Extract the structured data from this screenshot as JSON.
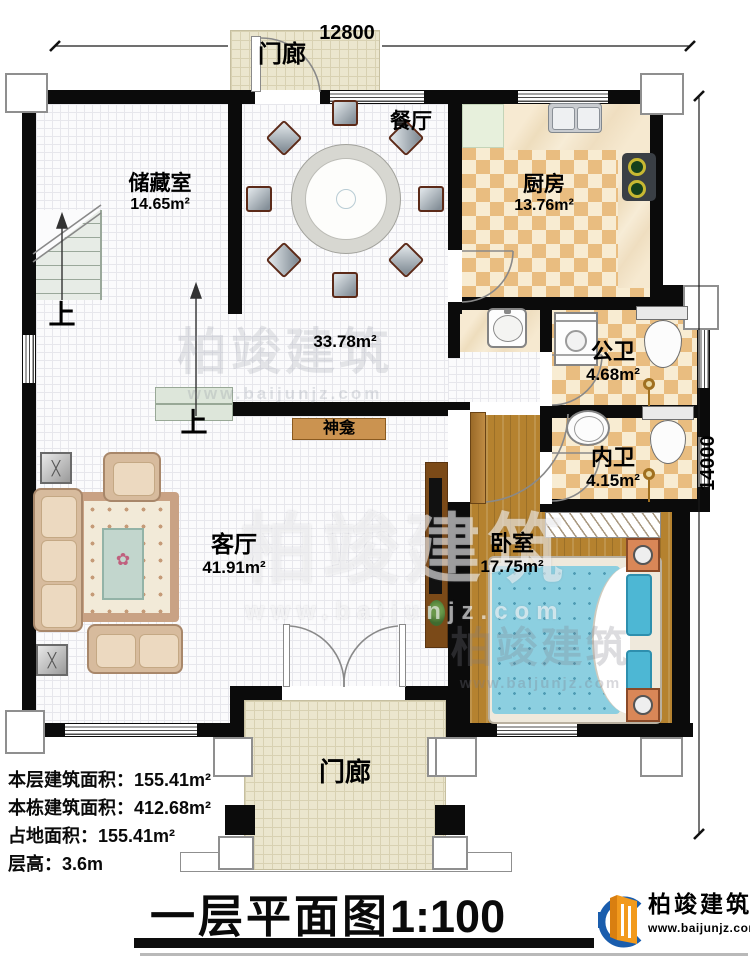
{
  "dimensions": {
    "width_label": "12800",
    "height_label": "14000"
  },
  "rooms": {
    "porch_top": {
      "name": "门廊"
    },
    "dining": {
      "name": "餐厅"
    },
    "kitchen": {
      "name": "厨房",
      "area": "13.76m²"
    },
    "storage": {
      "name": "储藏室",
      "area": "14.65m²"
    },
    "hall": {
      "area": "33.78m²"
    },
    "public_bath": {
      "name": "公卫",
      "area": "4.68m²"
    },
    "private_bath": {
      "name": "内卫",
      "area": "4.15m²"
    },
    "bedroom": {
      "name": "卧室",
      "area": "17.75m²"
    },
    "living": {
      "name": "客厅",
      "area": "41.91m²"
    },
    "shrine": {
      "name": "神龛"
    },
    "porch_bottom": {
      "name": "门廊"
    }
  },
  "stairs": {
    "up_label": "上"
  },
  "info": {
    "floor_area_label": "本层建筑面积：",
    "floor_area": "155.41m²",
    "building_area_label": "本栋建筑面积：",
    "building_area": "412.68m²",
    "footprint_label": "占地面积：",
    "footprint": "155.41m²",
    "height_label": "层高：",
    "height": "3.6m"
  },
  "title": {
    "main": "一层平面图",
    "scale": "1:100"
  },
  "brand": {
    "name": "柏竣建筑",
    "url": "www.baijunjz.com"
  }
}
